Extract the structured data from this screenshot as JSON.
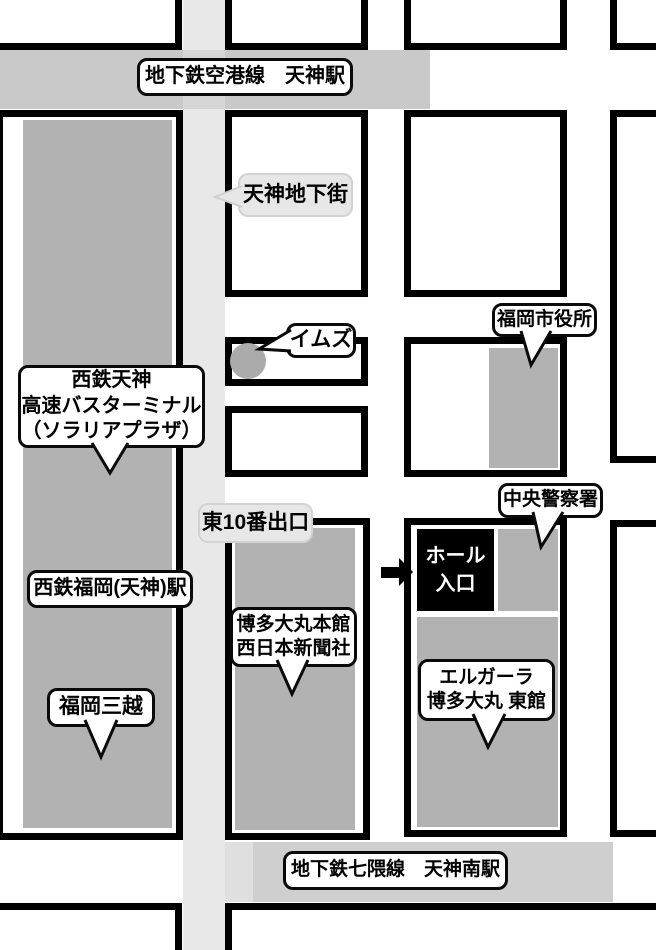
{
  "labels": {
    "airport_line": "地下鉄空港線　天神駅",
    "nanakuma_line": "地下鉄七隈線　天神南駅"
  },
  "callouts": {
    "tenjin_chikagai": {
      "text": "天神地下街"
    },
    "ims": {
      "text": "イムズ"
    },
    "city_hall": {
      "text": "福岡市役所"
    },
    "bus_terminal": {
      "lines": [
        "西鉄天神",
        "高速バスターミナル",
        "（ソラリアプラザ）"
      ]
    },
    "exit_east10": {
      "text": "東10番出口"
    },
    "central_police": {
      "text": "中央警察署"
    },
    "nishitetsu_station": {
      "text": "西鉄福岡(天神)駅"
    },
    "mitsukoshi": {
      "text": "福岡三越"
    },
    "daimaru": {
      "lines": [
        "博多大丸本館",
        "西日本新聞社"
      ]
    },
    "elgala": {
      "lines": [
        "エルガーラ",
        "博多大丸 東館"
      ]
    }
  },
  "hall_entrance": {
    "lines": [
      "ホール",
      "入口"
    ]
  },
  "colors": {
    "building_gray": "#b2b2b2",
    "subway_band_top": "#c9c9c9",
    "subway_band_bottom": "#cfcfcf",
    "street_light": "#e8e8e8",
    "bubble_gray": "#e7e7e7",
    "hall_black": "#000000",
    "ims_circle": "#ababab"
  }
}
